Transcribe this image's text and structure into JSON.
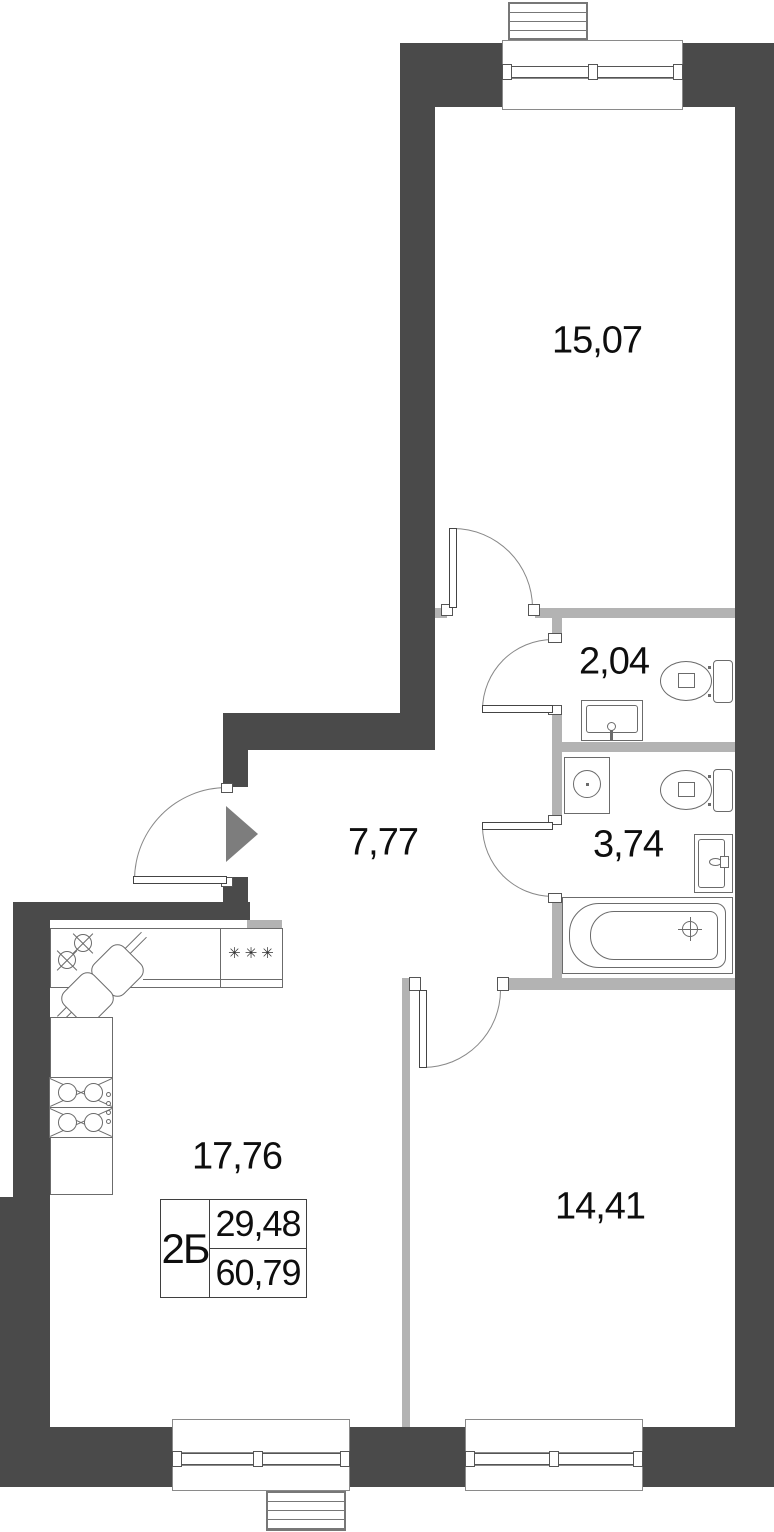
{
  "plan": {
    "title": "apartment-floor-plan",
    "rooms": [
      {
        "id": "living-room",
        "area": "15,07"
      },
      {
        "id": "wc",
        "area": "2,04"
      },
      {
        "id": "hallway",
        "area": "7,77"
      },
      {
        "id": "bathroom",
        "area": "3,74"
      },
      {
        "id": "kitchen-living",
        "area": "17,76"
      },
      {
        "id": "bedroom",
        "area": "14,41"
      }
    ],
    "stamp": {
      "type": "2Б",
      "living_area": "29,48",
      "total_area": "60,79"
    },
    "kitchen": {
      "stove_symbol": "✳✳✳"
    },
    "fixtures": [
      "toilet-icon",
      "toilet-icon",
      "sink-icon",
      "sink-icon",
      "bathtub-icon",
      "washing-machine-icon",
      "corner-kitchen-sink-icon",
      "stove-4-burner-icon",
      "entrance-arrow-icon",
      "door-swing-arc",
      "window",
      "balcony-hatch"
    ],
    "colors": {
      "wall_dark": "#4a4a4a",
      "wall_light": "#b3b3b3",
      "arrow": "#7d7d7d",
      "fixture_line": "#6b6b6b",
      "text": "#0e0e0e",
      "background": "#ffffff"
    }
  }
}
